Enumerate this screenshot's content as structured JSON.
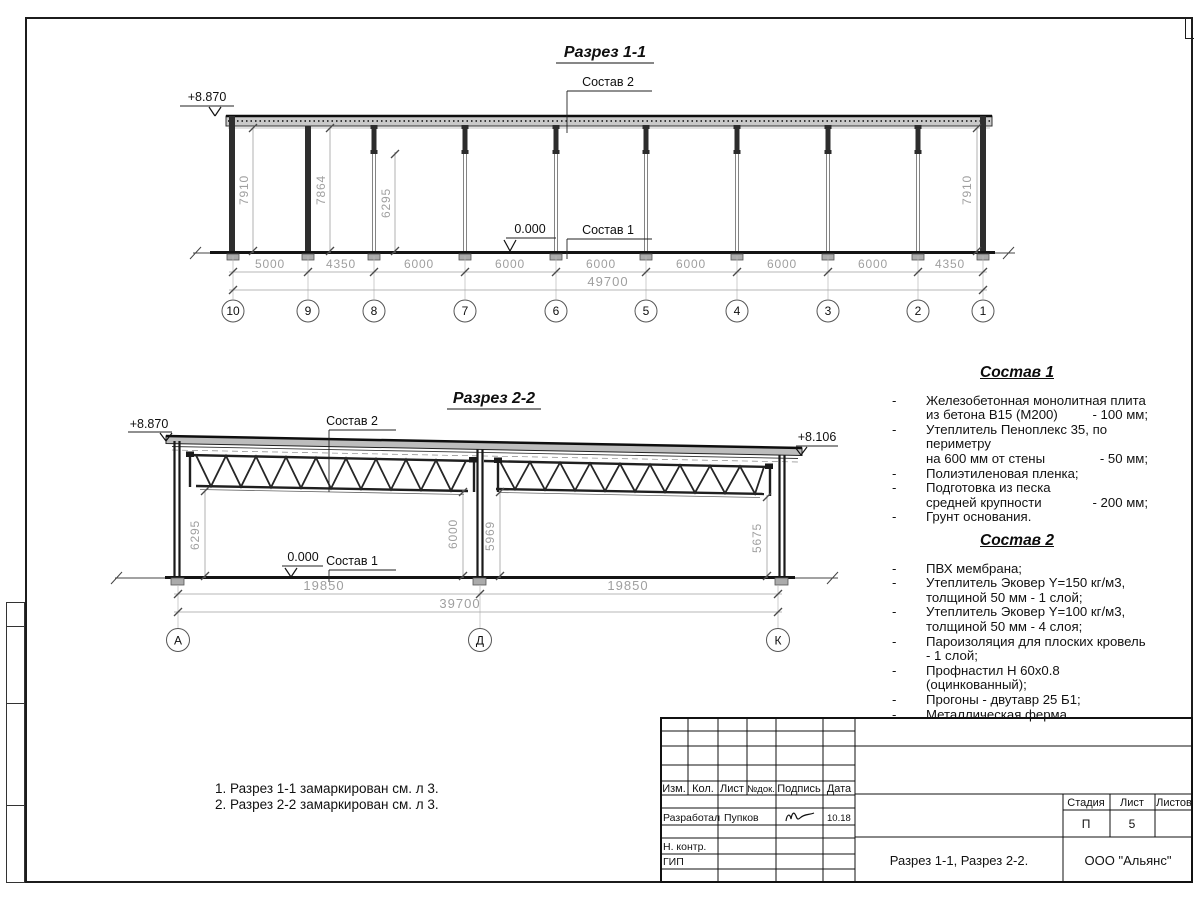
{
  "section1": {
    "title": "Разрез 1-1",
    "elevation_left": "+8.870",
    "zero_mark": "0.000",
    "sostav2_label": "Состав 2",
    "sostav1_label": "Состав 1",
    "vdims": [
      "7910",
      "7864",
      "6295",
      "7910"
    ],
    "hdims": [
      "5000",
      "4350",
      "6000",
      "6000",
      "6000",
      "6000",
      "6000",
      "6000",
      "4350"
    ],
    "total": "49700",
    "axes": [
      "10",
      "9",
      "8",
      "7",
      "6",
      "5",
      "4",
      "3",
      "2",
      "1"
    ]
  },
  "section2": {
    "title": "Разрез 2-2",
    "elevation_left": "+8.870",
    "elevation_right": "+8.106",
    "zero_mark": "0.000",
    "sostav2_label": "Состав 2",
    "sostav1_label": "Состав 1",
    "vdims": [
      "6295",
      "6000",
      "5969",
      "5675"
    ],
    "span_dims": [
      "19850",
      "19850"
    ],
    "total": "39700",
    "axes": [
      "А",
      "Д",
      "К"
    ]
  },
  "sostav1": {
    "title": "Состав 1",
    "dash": "-",
    "items": [
      {
        "l1": "Железобетонная  монолитная плита",
        "l2": "из бетона В15 (М200)",
        "v": "- 100 мм;"
      },
      {
        "l1": "Утеплитель Пеноплекс 35, по периметру",
        "l2": "на 600 мм от стены",
        "v": "- 50 мм;"
      },
      {
        "l1": "Полиэтиленовая пленка;"
      },
      {
        "l1": "Подготовка из песка",
        "l2": "средней крупности",
        "v": "- 200 мм;"
      },
      {
        "l1": "Грунт основания."
      }
    ]
  },
  "sostav2": {
    "title": "Состав 2",
    "dash": "-",
    "items": [
      {
        "l1": "ПВХ мембрана;"
      },
      {
        "l1": "Утеплитель Эковер Y=150 кг/м3,",
        "l2": "толщиной 50 мм - 1 слой;"
      },
      {
        "l1": "Утеплитель Эковер Y=100 кг/м3,",
        "l2": "толщиной 50 мм - 4 слоя;"
      },
      {
        "l1": "Пароизоляция для плоских кровель - 1 слой;"
      },
      {
        "l1": "Профнастил Н 60х0.8 (оцинкованный);"
      },
      {
        "l1": "Прогоны - двутавр 25 Б1;"
      },
      {
        "l1": "Металлическая ферма."
      }
    ]
  },
  "notes": {
    "line1": "1. Разрез 1-1 замаркирован см. л 3.",
    "line2": "2. Разрез 2-2 замаркирован см. л 3."
  },
  "titleblock": {
    "headers": {
      "izm": "Изм.",
      "kol": "Кол.",
      "list": "Лист",
      "ndok": "№док.",
      "podpis": "Подпись",
      "data": "Дата"
    },
    "razrabotal": "Разработал",
    "developer_name": "Пупков",
    "date": "10.18",
    "nkontr": "Н. контр.",
    "gip": "ГИП",
    "stage": {
      "stadia_label": "Стадия",
      "list_label": "Лист",
      "listov_label": "Листов",
      "stadia": "П",
      "list": "5"
    },
    "doc_title": "Разрез 1-1, Разрез 2-2.",
    "company": "ООО \"Альянс\""
  }
}
